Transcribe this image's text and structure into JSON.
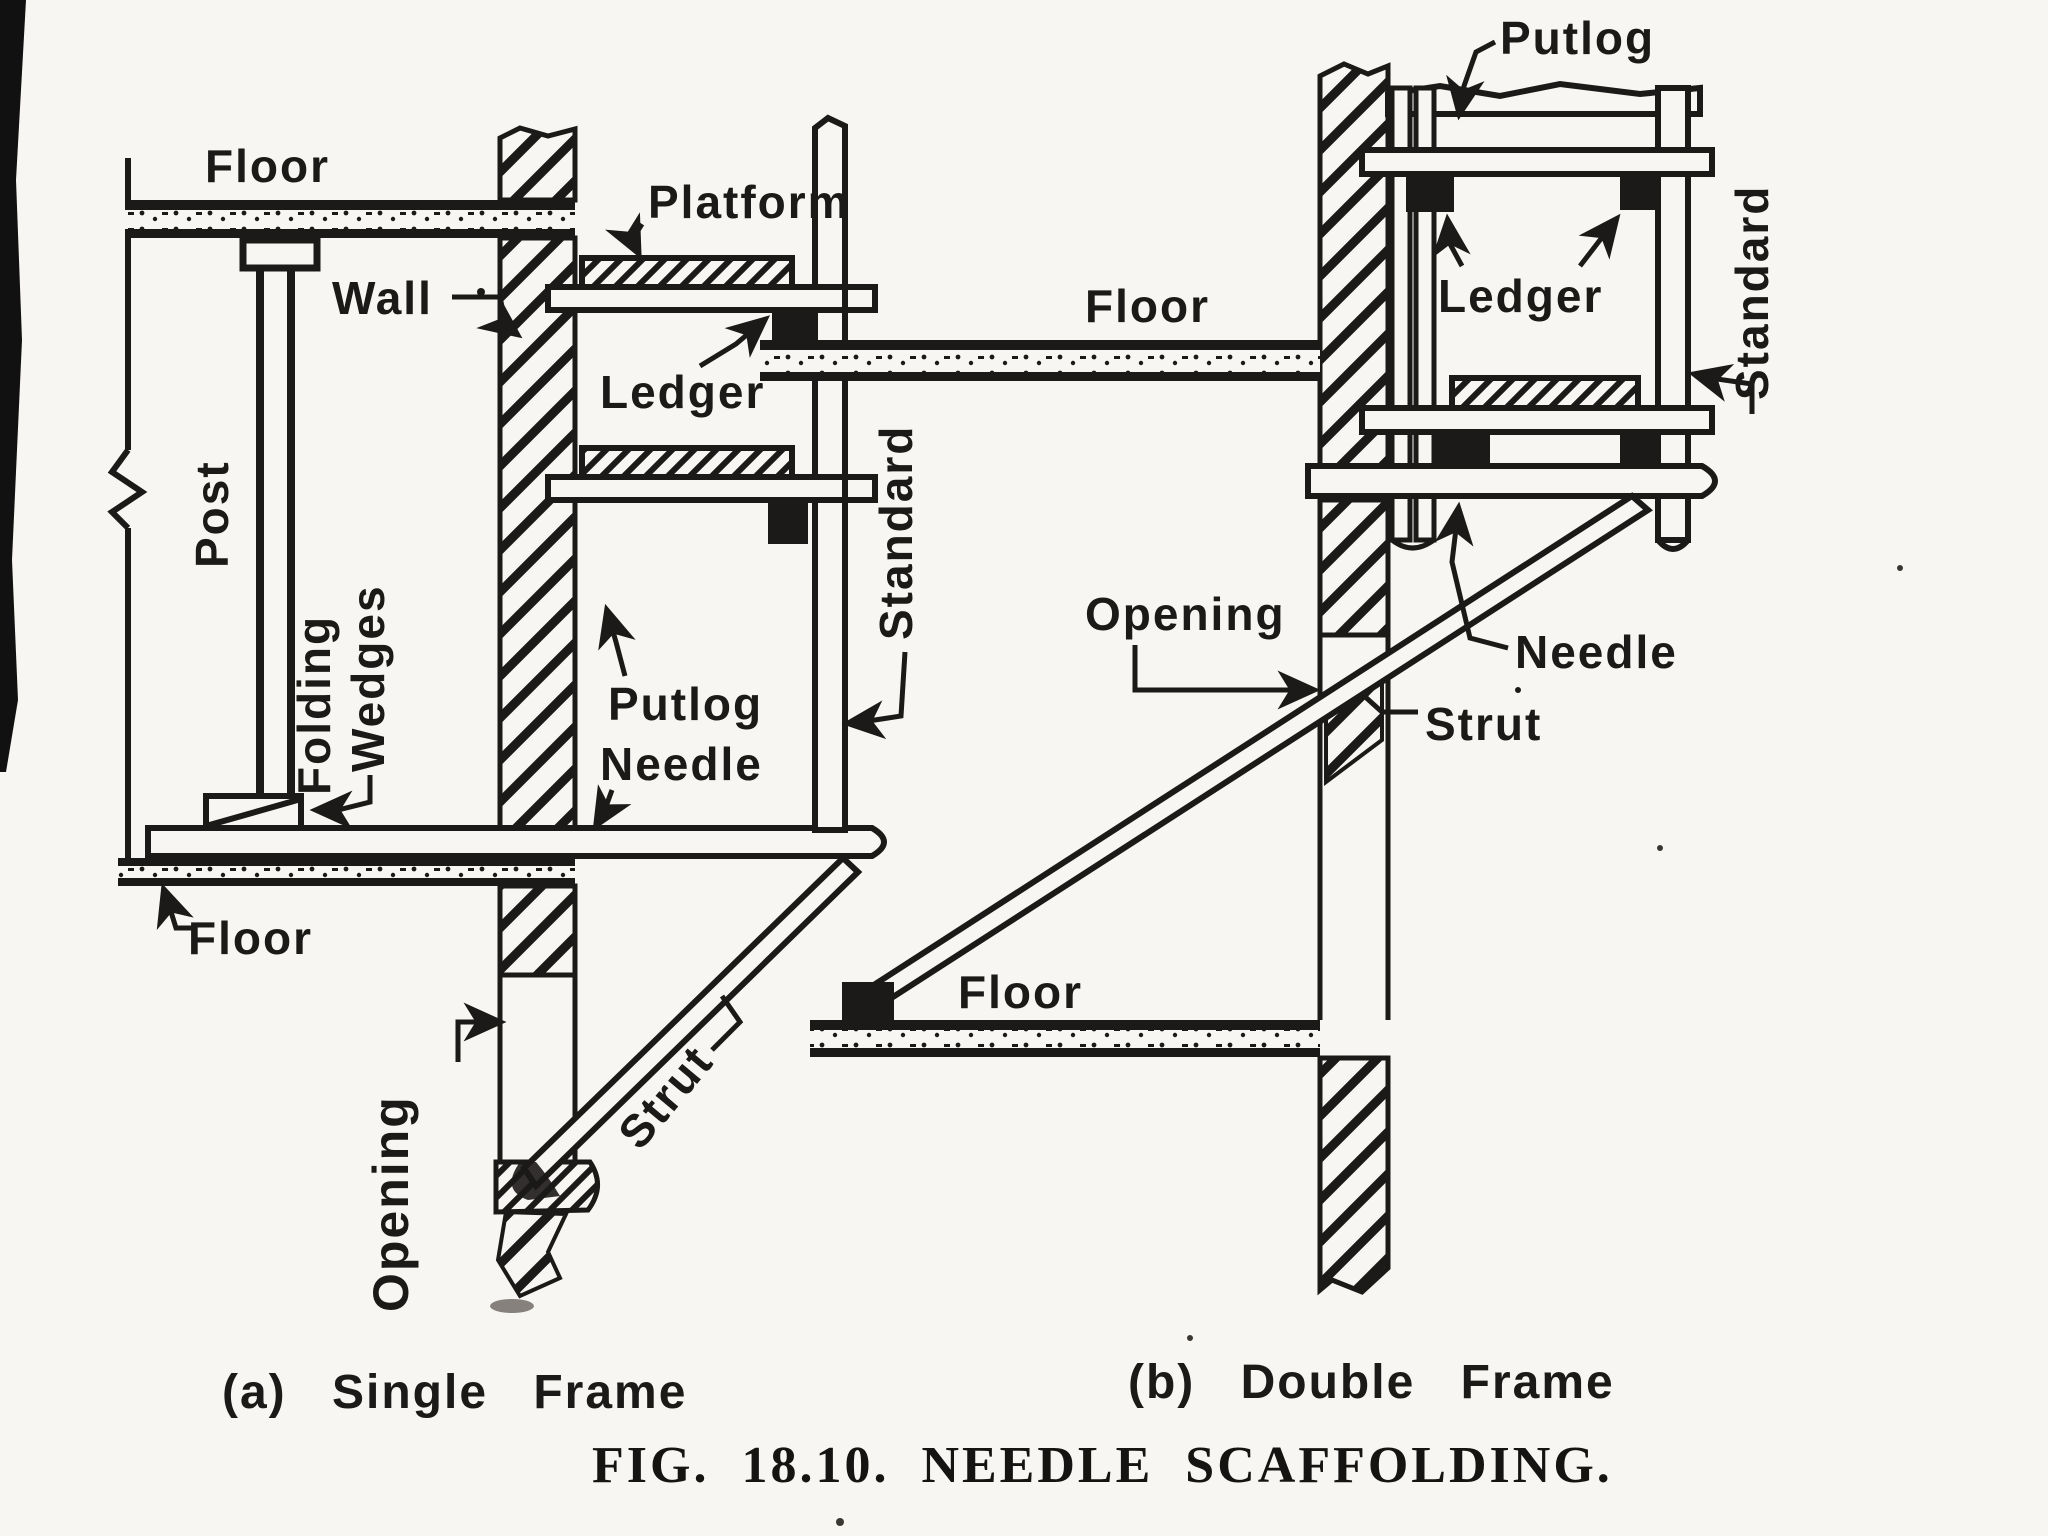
{
  "figure": {
    "caption_a": "(a) Single Frame",
    "caption_b": "(b) Double Frame",
    "title": "FIG. 18.10. NEEDLE SCAFFOLDING."
  },
  "diagram_a": {
    "name": "Single Frame needle scaffold section",
    "labels": {
      "floor_top": "Floor",
      "wall": "Wall",
      "platform": "Platform",
      "ledger": "Ledger",
      "post": "Post",
      "folding_wedges_line1": "Folding",
      "folding_wedges_line2": "Wedges",
      "putlog": "Putlog",
      "needle": "Needle",
      "standard": "Standard",
      "floor_bottom": "Floor",
      "opening": "Opening",
      "strut": "Strut"
    }
  },
  "diagram_b": {
    "name": "Double Frame needle scaffold section",
    "labels": {
      "putlog": "Putlog",
      "floor_upper": "Floor",
      "ledger": "Ledger",
      "standard": "Standard",
      "opening": "Opening",
      "needle": "Needle",
      "strut": "Strut",
      "floor_lower": "Floor"
    }
  },
  "colors": {
    "ink": "#1c1a18",
    "paper": "#f8f6f2"
  }
}
